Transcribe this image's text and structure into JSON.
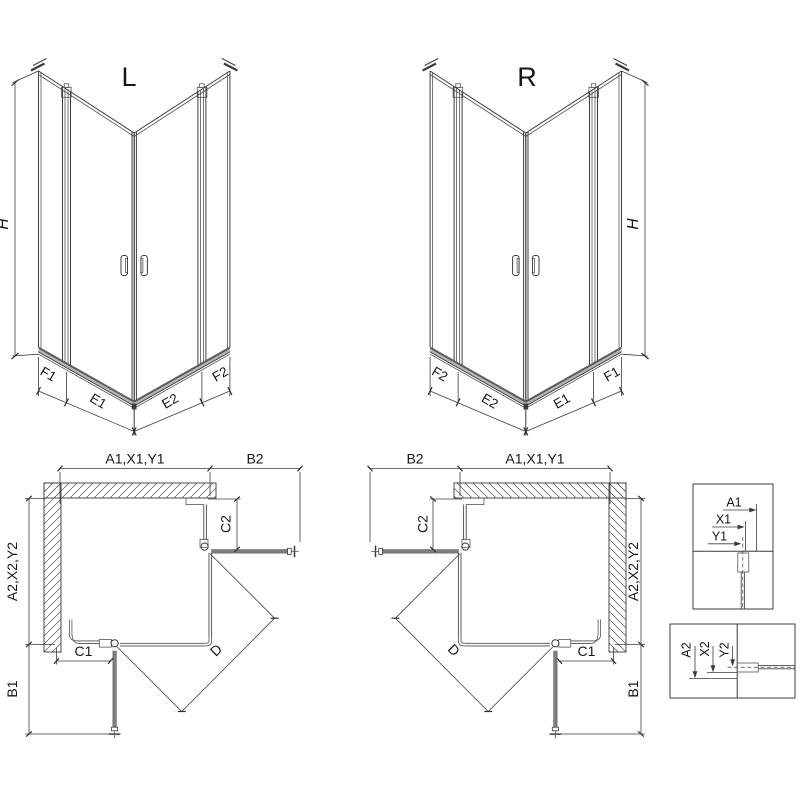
{
  "drawing": {
    "iso_left": {
      "label": "L",
      "height_label": "H",
      "segment_labels": [
        "F1",
        "E1",
        "E2",
        "F2"
      ]
    },
    "iso_right": {
      "label": "R",
      "height_label": "H",
      "segment_labels": [
        "F2",
        "E2",
        "E1",
        "F1"
      ]
    },
    "plan_left": {
      "width_label": "A1,X1,Y1",
      "door_reach_top_label": "B2",
      "fixed_top_label": "C2",
      "depth_label": "A2,X2,Y2",
      "door_reach_side_label": "B1",
      "fixed_bottom_label": "C1",
      "diagonal_label": "D"
    },
    "plan_right": {
      "width_label": "A1,X1,Y1",
      "door_reach_top_label": "B2",
      "fixed_top_label": "C2",
      "depth_label": "A2,X2,Y2",
      "door_reach_side_label": "B1",
      "fixed_bottom_label": "C1",
      "diagonal_label": "D"
    },
    "detail_top": {
      "dim_labels": [
        "A1",
        "X1",
        "Y1"
      ]
    },
    "detail_bottom": {
      "dim_labels": [
        "A2",
        "X2",
        "Y2"
      ]
    },
    "colors": {
      "line": "#3c3c3c",
      "open_door_bar": "#7f7f7f",
      "tray_band": "#b3b3b3",
      "hatch": "#6e6e6e"
    }
  }
}
